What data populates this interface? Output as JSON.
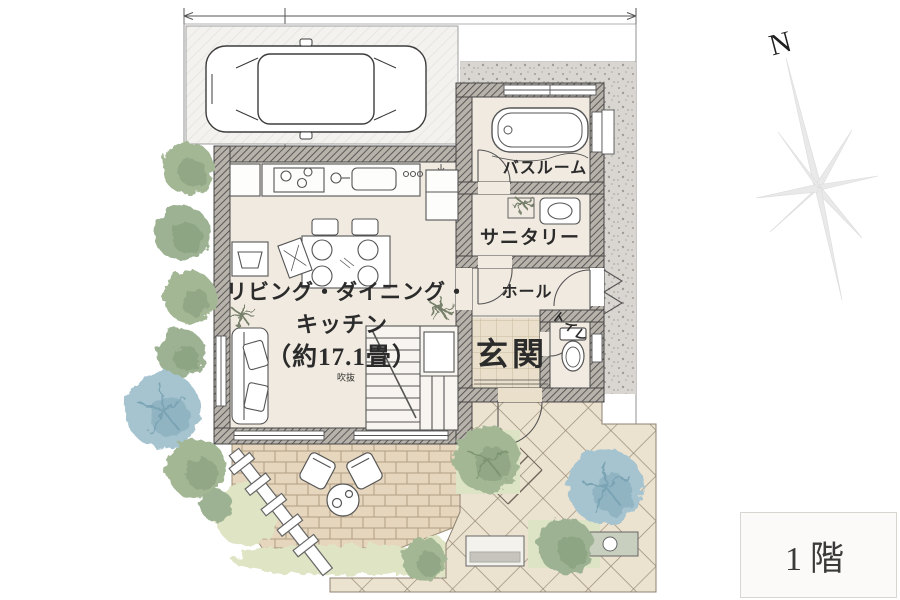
{
  "floor_badge": {
    "label": "1階"
  },
  "compass": {
    "label": "N"
  },
  "rooms": {
    "ldk_line1": "リビング・ダイニング・",
    "ldk_line2": "キッチン",
    "ldk_size": "（約17.1畳）",
    "void_label": "吹抜",
    "bathroom": "バスルーム",
    "sanitary": "サニタリー",
    "hall": "ホール",
    "toilet": "トイレ",
    "entrance": "玄関"
  },
  "colors": {
    "wall_hatch": "#4a4a4a",
    "room_floor": "#f1eae0",
    "terrace_brick": "#e6d6bd",
    "walkway_tile": "#ece2d0",
    "entrance_tile": "#eadfcb",
    "gravel": "#d9d6d1",
    "grass": "#dfe5c4",
    "tree_green": "#a3b795",
    "tree_blue": "#a6c4d0"
  }
}
